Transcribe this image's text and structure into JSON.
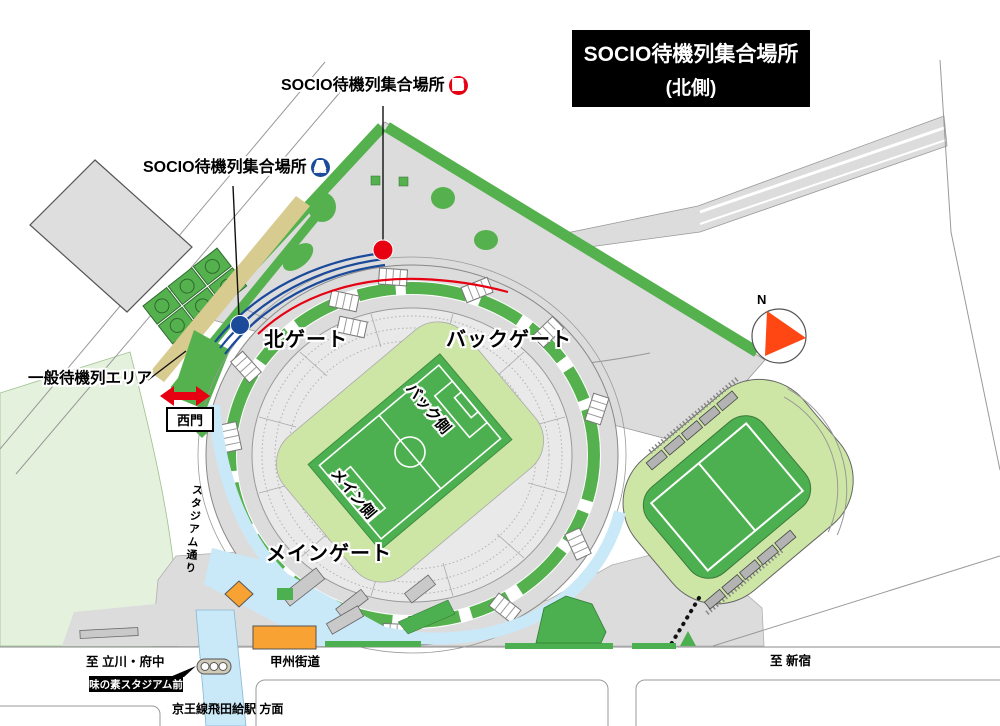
{
  "title": {
    "line1": "SOCIO待機列集合場所",
    "line2": "(北側)"
  },
  "callouts": {
    "socio_b": {
      "text": "SOCIO待機列集合場所",
      "badge": "B",
      "badge_color": "#E60012"
    },
    "socio_a": {
      "text": "SOCIO待機列集合場所",
      "badge": "A",
      "badge_color": "#1B4A9B"
    },
    "general_waiting_area": {
      "text": "一般待機列エリア"
    }
  },
  "gates": {
    "north": "北ゲート",
    "back": "バックゲート",
    "main": "メインゲート",
    "west": "西門"
  },
  "stadium_sides": {
    "back_side": "バック側",
    "main_side": "メイン側"
  },
  "roads": {
    "koshu_kaido": "甲州街道",
    "stadium_street": "スタジアム通り"
  },
  "directions": {
    "to_tachikawa_fuchu": "至 立川・府中",
    "to_shinjuku": "至 新宿",
    "to_tobitakyu_station": "京王線飛田給駅 方面"
  },
  "transit": {
    "bus_stop_name": "味の素スタジアム前"
  },
  "compass": {
    "north": "N"
  },
  "colors": {
    "marker_a_blue": "#1B4A9B",
    "marker_b_red": "#E60012",
    "queue_blue": "#1B4A9B",
    "queue_red": "#E60012",
    "map_green": "#55B14E",
    "pitch_green": "#4CB050",
    "pale_green": "#CDE6A5",
    "light_green_bg": "#E4F1DC",
    "khaki_waiting_strip": "#D8CB90",
    "walkway_blue": "#C9E8F8",
    "building_orange": "#F7A233",
    "concourse_gray": "#DCDCDC",
    "compass_orange": "#FF4713",
    "title_bg": "#000000"
  }
}
